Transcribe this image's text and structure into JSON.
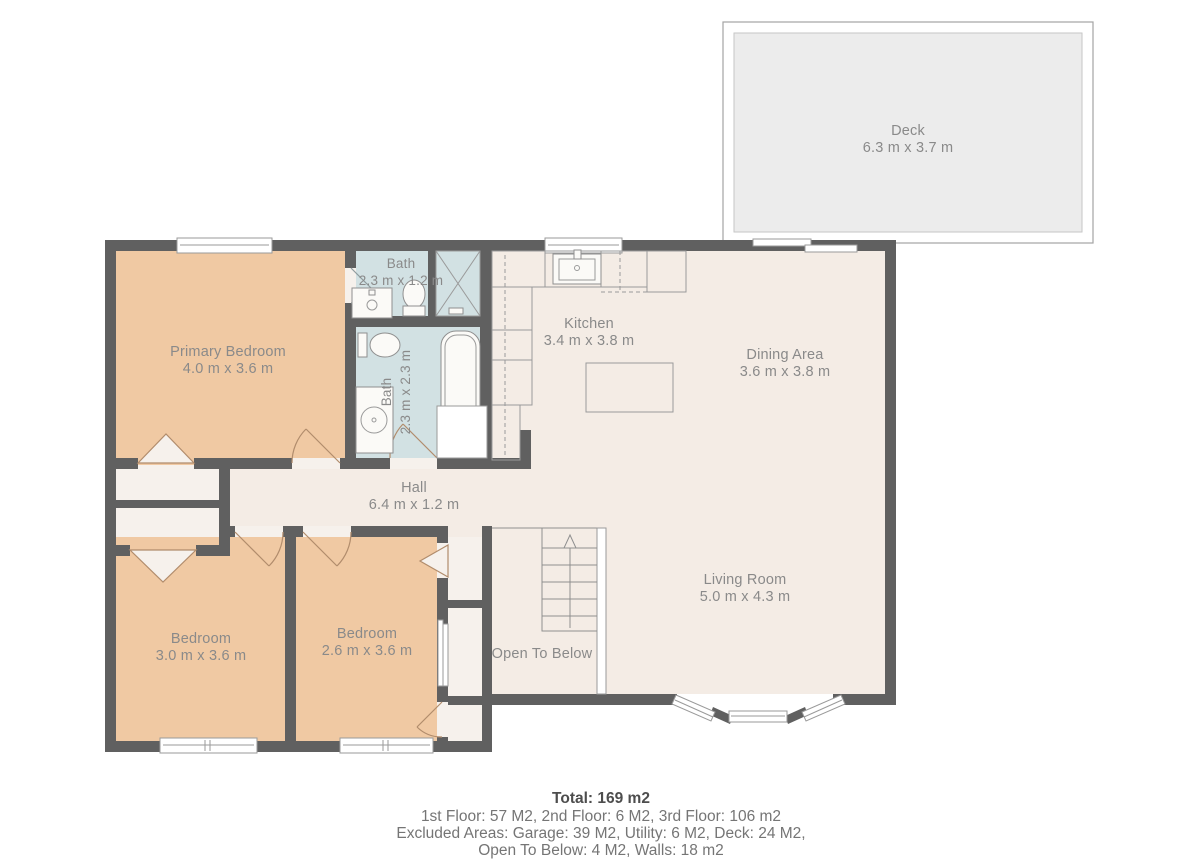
{
  "floorplan": {
    "rooms": {
      "deck": {
        "name": "Deck",
        "dims": "6.3 m x 3.7 m"
      },
      "primary_bedroom": {
        "name": "Primary Bedroom",
        "dims": "4.0 m x 3.6 m"
      },
      "bath_small": {
        "name": "Bath",
        "dims": "2.3 m x 1.2 m"
      },
      "bath_large": {
        "name": "Bath",
        "dims": "2.3 m x 2.3 m"
      },
      "kitchen": {
        "name": "Kitchen",
        "dims": "3.4 m x 3.8 m"
      },
      "dining_area": {
        "name": "Dining Area",
        "dims": "3.6 m x 3.8 m"
      },
      "hall": {
        "name": "Hall",
        "dims": "6.4 m x 1.2 m"
      },
      "bedroom_left": {
        "name": "Bedroom",
        "dims": "3.0 m x 3.6 m"
      },
      "bedroom_mid": {
        "name": "Bedroom",
        "dims": "2.6 m x 3.6 m"
      },
      "living_room": {
        "name": "Living Room",
        "dims": "5.0 m x 4.3 m"
      },
      "open_to_below": {
        "name": "Open To Below"
      }
    },
    "summary": {
      "total": "Total: 169 m2",
      "line1": "1st Floor: 57 M2, 2nd Floor: 6 M2, 3rd Floor: 106 m2",
      "line2": "Excluded Areas: Garage: 39 M2, Utility: 6 M2, Deck: 24 M2,",
      "line3": "Open To Below: 4 M2, Walls: 18 m2"
    },
    "colors": {
      "wall": "#606060",
      "bedroom_fill": "#f0c9a3",
      "bathroom_fill": "#d2e1e3",
      "floor_fill": "#f4ece5",
      "closet_fill": "#f6f1ec",
      "deck_fill": "#ececec",
      "label_text": "#8a8a8a",
      "summary_text": "#757575"
    }
  }
}
